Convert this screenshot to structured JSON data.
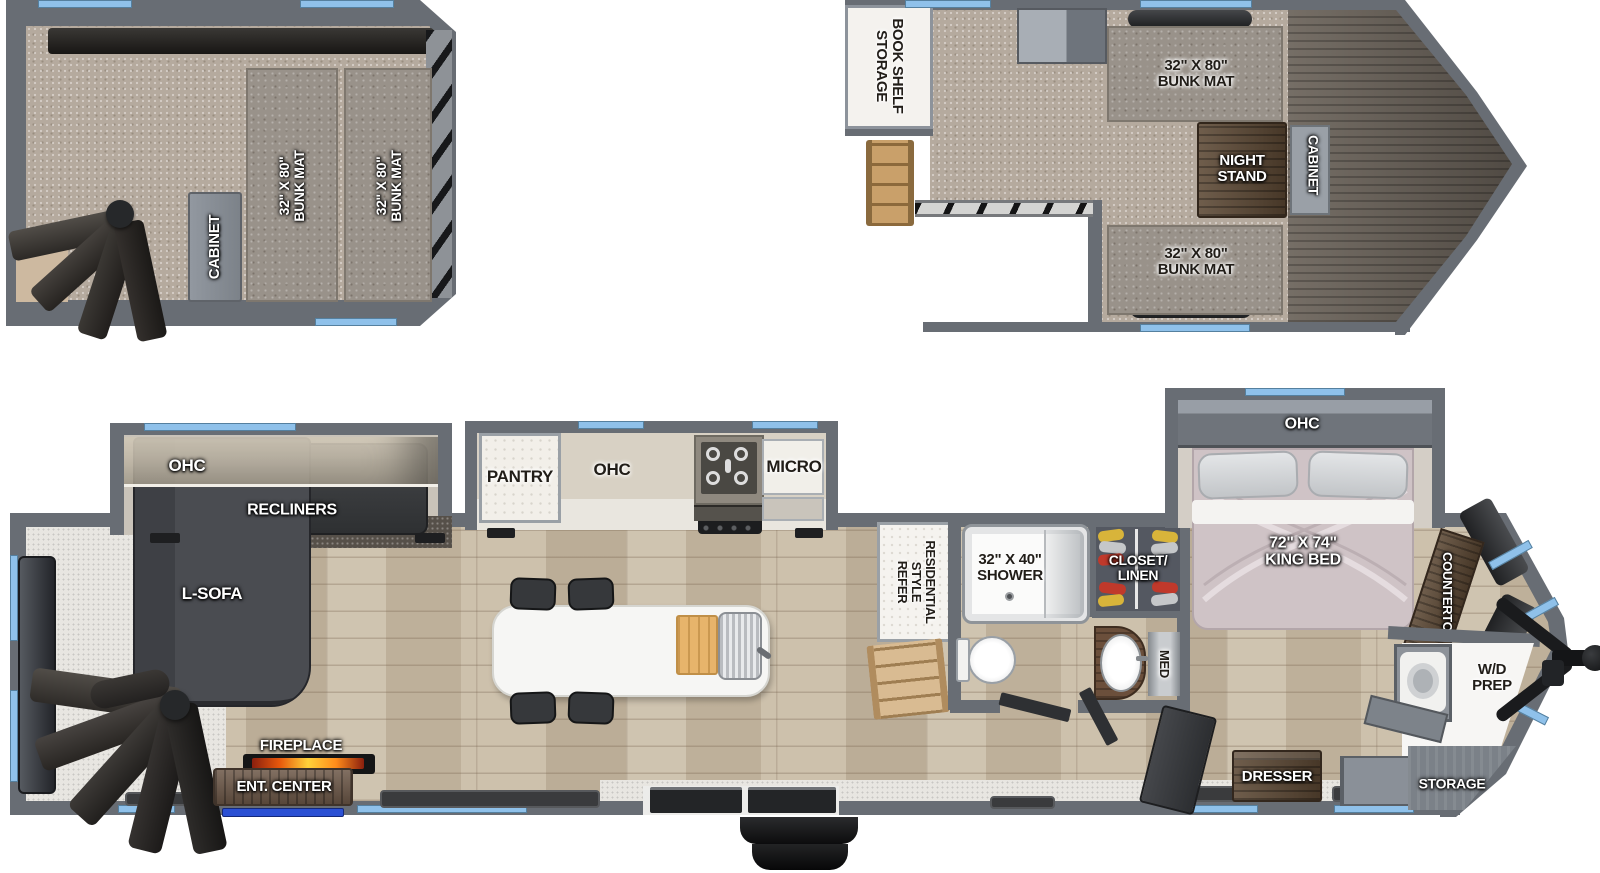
{
  "colors": {
    "wall_gray": "#686d74",
    "window_blue": "#8fc1ea",
    "led_blue": "#2b50d4",
    "flame_orange": "#ff8c1a",
    "carpet_tan": "#b5aa9e",
    "bed_mauve": "#cfc3c6"
  },
  "rear_loft": {
    "cabinet": "CABINET",
    "bunk1_l1": "32\" X 80\"",
    "bunk1_l2": "BUNK MAT",
    "bunk2_l1": "32\" X 80\"",
    "bunk2_l2": "BUNK MAT"
  },
  "front_loft": {
    "bookshelf_l1": "BOOK SHELF",
    "bookshelf_l2": "STORAGE",
    "bunk_top_l1": "32\" X 80\"",
    "bunk_top_l2": "BUNK MAT",
    "nightstand_l1": "NIGHT",
    "nightstand_l2": "STAND",
    "cabinet": "CABINET",
    "bunk_bottom_l1": "32\" X 80\"",
    "bunk_bottom_l2": "BUNK MAT"
  },
  "living": {
    "ohc": "OHC",
    "recliners": "RECLINERS",
    "sofa": "L-SOFA",
    "fireplace": "FIREPLACE",
    "ent_center": "ENT. CENTER"
  },
  "kitchen": {
    "pantry": "PANTRY",
    "ohc": "OHC",
    "micro": "MICRO",
    "refer_l1": "RESIDENTIAL",
    "refer_l2": "STYLE",
    "refer_l3": "REFER"
  },
  "bath": {
    "shower_l1": "32\" X 40\"",
    "shower_l2": "SHOWER",
    "closet_l1": "CLOSET/",
    "closet_l2": "LINEN",
    "med": "MED"
  },
  "bedroom": {
    "ohc": "OHC",
    "bed_l1": "72\" X 74\"",
    "bed_l2": "KING BED",
    "countertop": "COUNTERTOP",
    "dresser": "DRESSER"
  },
  "front_cap": {
    "wd_l1": "W/D",
    "wd_l2": "PREP",
    "storage": "STORAGE"
  }
}
